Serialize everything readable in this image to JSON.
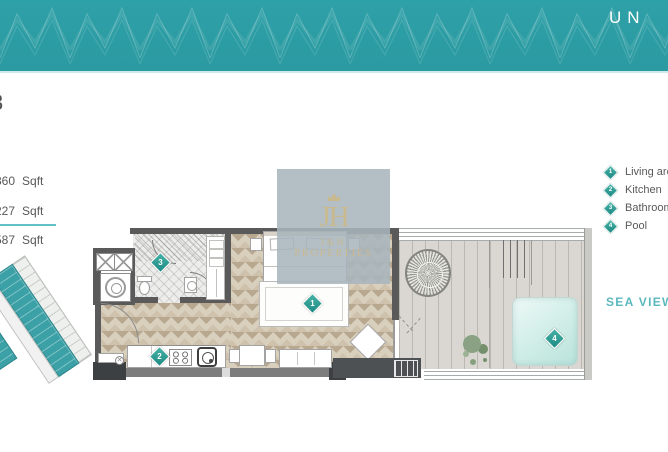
{
  "header": {
    "title": "UN",
    "bg_color": "#2E9FA6"
  },
  "unit": {
    "number_fragment": "3"
  },
  "area_table": {
    "rows": [
      {
        "value": "360",
        "unit": "Sqft"
      },
      {
        "value": "227",
        "unit": "Sqft"
      }
    ],
    "total_row": {
      "value": "587",
      "unit": "Sqft"
    }
  },
  "legend": {
    "items": [
      {
        "num": "1",
        "label": "Living area"
      },
      {
        "num": "2",
        "label": "Kitchen"
      },
      {
        "num": "3",
        "label": "Bathroom"
      },
      {
        "num": "4",
        "label": "Pool"
      }
    ]
  },
  "view_label": "SEA VIEW",
  "floorplan": {
    "markers": [
      {
        "num": "1",
        "room": "living-area"
      },
      {
        "num": "2",
        "room": "kitchen"
      },
      {
        "num": "3",
        "room": "bathroom"
      },
      {
        "num": "4",
        "room": "pool"
      }
    ]
  },
  "watermark": {
    "monogram": "JH",
    "name": "J&H",
    "subtitle": "PROPERTIES"
  },
  "colors": {
    "teal": "#2E9FA6",
    "diamond_teal": "#2AA49B",
    "gold": "#C9B98F",
    "sea_view_text": "#5BB8BD",
    "pool": "#C8E9E4"
  }
}
